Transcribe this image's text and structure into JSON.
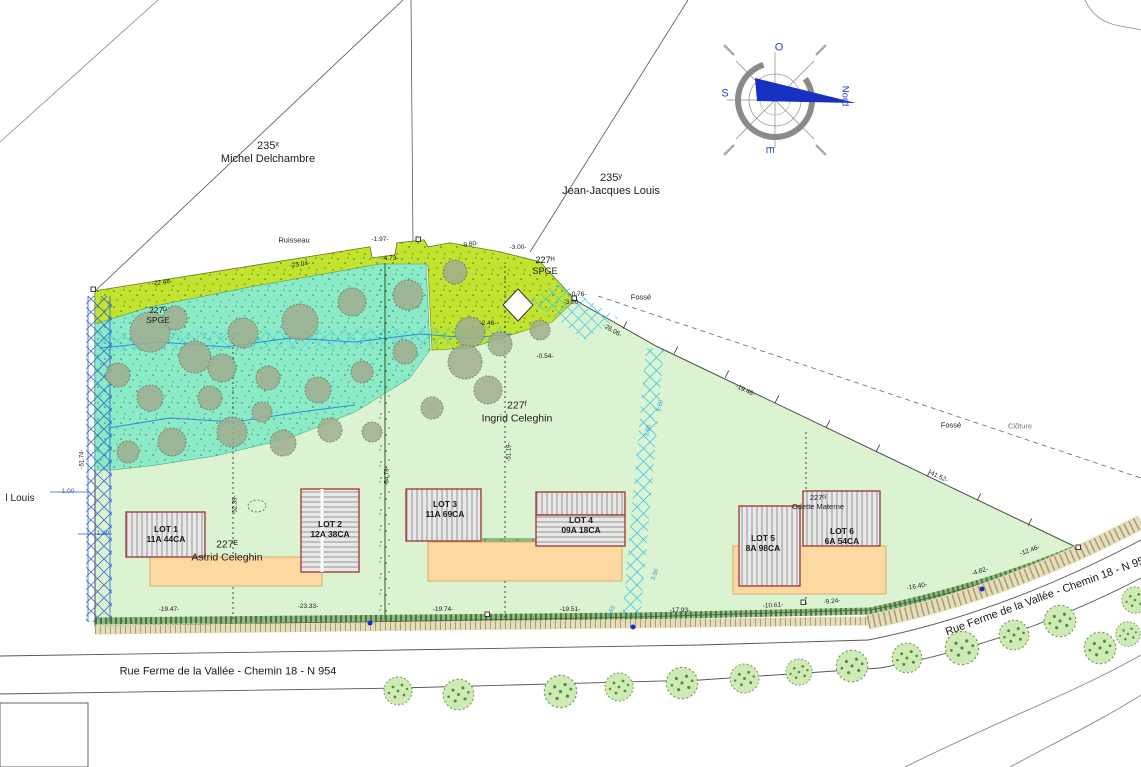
{
  "canvas": {
    "width": 1141,
    "height": 767
  },
  "colors": {
    "parcel_green": "#dcf3d2",
    "wooded_teal": "#8beac8",
    "meadow_chartreuse": "#c3e42e",
    "terrace_orange": "#fcd9a0",
    "building_hatch": "#e8e8e8",
    "building_border": "#a04040",
    "drainage_blue": "#2a5fd0",
    "drainage_cyan": "#38c4ea",
    "compass_arrow_blue": "#1630c2",
    "hedge_green": "#4e8f3f",
    "gravel_tan": "#e6ddbb"
  },
  "lots": [
    {
      "name": "LOT 1",
      "area": "11A 44CA"
    },
    {
      "name": "LOT 2",
      "area": "12A 38CA"
    },
    {
      "name": "LOT 3",
      "area": "11A 69CA"
    },
    {
      "name": "LOT 4",
      "area": "09A 18CA"
    },
    {
      "name": "LOT 5",
      "area": "8A 98CA"
    },
    {
      "name": "LOT 6",
      "area": "6A 54CA"
    }
  ],
  "annotations": [
    {
      "name": "owner-parcel-235x",
      "text": "235ˣ\nMichel Delchambre",
      "x": 268,
      "y": 153,
      "size": 11
    },
    {
      "name": "owner-parcel-235y",
      "text": "235ʸ\nJean-Jacques Louis",
      "x": 611,
      "y": 185,
      "size": 11
    },
    {
      "name": "ruisseau-label",
      "text": "Ruisseau",
      "x": 294,
      "y": 240,
      "size": 7.5
    },
    {
      "name": "measure-197",
      "text": "-1.97-",
      "x": 380,
      "y": 240,
      "size": 6.5
    },
    {
      "name": "measure-473",
      "text": "-4.73-",
      "x": 390,
      "y": 259,
      "size": 6.5
    },
    {
      "name": "measure-980",
      "text": "-9.80-",
      "x": 470,
      "y": 245,
      "size": 6.5,
      "rot": -10
    },
    {
      "name": "measure-300a",
      "text": "-3.00-",
      "x": 518,
      "y": 248,
      "size": 6.5
    },
    {
      "name": "parcel-227h-spge",
      "text": "227ᴴ\nSPGE",
      "x": 545,
      "y": 266,
      "size": 9
    },
    {
      "name": "measure-076",
      "text": "-0.76-",
      "x": 578,
      "y": 295,
      "size": 6.5
    },
    {
      "name": "measure-300b",
      "text": "-3.00-",
      "x": 572,
      "y": 303,
      "size": 6.5
    },
    {
      "name": "fosse-label-1",
      "text": "Fossé",
      "x": 641,
      "y": 297,
      "size": 7.5
    },
    {
      "name": "measure-2304",
      "text": "-23.04-",
      "x": 300,
      "y": 265,
      "size": 6.5,
      "rot": -8
    },
    {
      "name": "measure-2248",
      "text": "-22.48-",
      "x": 162,
      "y": 283,
      "size": 6.5,
      "rot": -8
    },
    {
      "name": "parcel-227d-spge",
      "text": "227ᴰ\nSPGE",
      "x": 158,
      "y": 315,
      "size": 8.5
    },
    {
      "name": "measure-2606",
      "text": "-26.06-",
      "x": 612,
      "y": 331,
      "size": 6.5,
      "rot": 30
    },
    {
      "name": "measure-1946",
      "text": "-19.46-",
      "x": 745,
      "y": 391,
      "size": 6.5,
      "rot": 25
    },
    {
      "name": "fosse-label-2",
      "text": "Fossé",
      "x": 951,
      "y": 425,
      "size": 7.5
    },
    {
      "name": "cloture-label",
      "text": "Clôture",
      "x": 1020,
      "y": 426,
      "size": 7.5,
      "color": "#777777"
    },
    {
      "name": "measure-4152",
      "text": "-41.52-",
      "x": 938,
      "y": 477,
      "size": 6.5,
      "rot": 25
    },
    {
      "name": "owner-parcel-227f",
      "text": "227ᶠ\nIngrid Celeghin",
      "x": 517,
      "y": 412,
      "size": 10.5
    },
    {
      "name": "owner-parcel-227e",
      "text": "227ᴱ\nAstrid Celeghin",
      "x": 227,
      "y": 551,
      "size": 10.5
    },
    {
      "name": "owner-parcel-227g",
      "text": "227ᴳ\nOdette Materne",
      "x": 818,
      "y": 502,
      "size": 7.5
    },
    {
      "name": "lot-1-label",
      "text": "LOT 1\n11A 44CA",
      "x": 166,
      "y": 534,
      "size": 8.5,
      "weight": "bold"
    },
    {
      "name": "lot-2-label",
      "text": "LOT 2\n12A 38CA",
      "x": 330,
      "y": 529,
      "size": 8.5,
      "weight": "bold"
    },
    {
      "name": "lot-3-label",
      "text": "LOT 3\n11A 69CA",
      "x": 445,
      "y": 509,
      "size": 8.5,
      "weight": "bold"
    },
    {
      "name": "lot-4-label",
      "text": "LOT 4\n09A 18CA",
      "x": 581,
      "y": 525,
      "size": 8.5,
      "weight": "bold"
    },
    {
      "name": "lot-5-label",
      "text": "LOT 5\n8A 98CA",
      "x": 763,
      "y": 543,
      "size": 8.5,
      "weight": "bold"
    },
    {
      "name": "lot-6-label",
      "text": "LOT 6\n6A 54CA",
      "x": 842,
      "y": 536,
      "size": 8.5,
      "weight": "bold"
    },
    {
      "name": "measure-1947",
      "text": "-19.47-",
      "x": 169,
      "y": 610,
      "size": 6.5
    },
    {
      "name": "measure-2333",
      "text": "-23.33-",
      "x": 308,
      "y": 607,
      "size": 6.5
    },
    {
      "name": "measure-1974",
      "text": "-19.74-",
      "x": 443,
      "y": 610,
      "size": 6.5
    },
    {
      "name": "measure-1951",
      "text": "-19.51-",
      "x": 570,
      "y": 610,
      "size": 6.5
    },
    {
      "name": "measure-1793",
      "text": "-17.93-",
      "x": 680,
      "y": 611,
      "size": 6.5
    },
    {
      "name": "measure-1061",
      "text": "-10.61-",
      "x": 773,
      "y": 606,
      "size": 6.5,
      "rot": -4
    },
    {
      "name": "measure-924",
      "text": "-9.24-",
      "x": 832,
      "y": 602,
      "size": 6.5,
      "rot": -5
    },
    {
      "name": "measure-1640",
      "text": "-16.40-",
      "x": 917,
      "y": 587,
      "size": 6.5,
      "rot": -10
    },
    {
      "name": "measure-482",
      "text": "-4.82-",
      "x": 980,
      "y": 572,
      "size": 6.5,
      "rot": -16
    },
    {
      "name": "measure-1246",
      "text": "-12.46-",
      "x": 1030,
      "y": 551,
      "size": 6.5,
      "rot": -20
    },
    {
      "name": "road-name-bottom",
      "text": "Rue Ferme de la Vallée - Chemin 18 - N 954",
      "x": 228,
      "y": 672,
      "size": 11
    },
    {
      "name": "road-name-right",
      "text": "Rue Ferme de la Vallée - Chemin 18 - N 954",
      "x": 1048,
      "y": 596,
      "size": 11,
      "rot": -20
    },
    {
      "name": "owner-left-cut",
      "text": "l Louis",
      "x": 20,
      "y": 499,
      "size": 10
    },
    {
      "name": "measure-5174",
      "text": "-51.74-",
      "x": 83,
      "y": 459,
      "size": 6,
      "rot": -90
    },
    {
      "name": "measure-100a",
      "text": "1.00",
      "x": 68,
      "y": 492,
      "size": 6.5,
      "color": "#2a5fd0"
    },
    {
      "name": "measure-100b",
      "text": "1.00",
      "x": 103,
      "y": 534,
      "size": 6.5,
      "color": "#2a5fd0"
    },
    {
      "name": "measure-5239",
      "text": "-52.39-",
      "x": 236,
      "y": 505,
      "size": 6,
      "rot": -90
    },
    {
      "name": "measure-5479",
      "text": "-54.79-",
      "x": 388,
      "y": 476,
      "size": 6,
      "rot": -90
    },
    {
      "name": "measure-5119",
      "text": "-51.19-",
      "x": 510,
      "y": 452,
      "size": 6,
      "rot": -90
    },
    {
      "name": "measure-160",
      "text": "1.60",
      "x": 661,
      "y": 406,
      "size": 6,
      "rot": -75,
      "color": "#2a9fd0"
    },
    {
      "name": "measure-150",
      "text": "1.50",
      "x": 649,
      "y": 431,
      "size": 6,
      "rot": -75,
      "color": "#2a9fd0"
    },
    {
      "name": "measure-350",
      "text": "3.50",
      "x": 656,
      "y": 575,
      "size": 6,
      "rot": -70,
      "color": "#2a9fd0"
    },
    {
      "name": "measure-355",
      "text": "3.55",
      "x": 612,
      "y": 612,
      "size": 6,
      "rot": -60,
      "color": "#2a9fd0"
    },
    {
      "name": "measure-054",
      "text": "-0.54-",
      "x": 545,
      "y": 357,
      "size": 6.5
    },
    {
      "name": "measure-246",
      "text": "-2.46-",
      "x": 488,
      "y": 324,
      "size": 6.5
    },
    {
      "name": "compass-west-label",
      "text": "O",
      "x": 779,
      "y": 48,
      "size": 11,
      "color": "#2a3fd0"
    },
    {
      "name": "compass-south-label",
      "text": "S",
      "x": 725,
      "y": 94,
      "size": 11,
      "color": "#2a3fd0"
    },
    {
      "name": "compass-east-label",
      "text": "E",
      "x": 769,
      "y": 150,
      "size": 11,
      "color": "#2a3fd0",
      "rot": 90
    },
    {
      "name": "compass-north-label",
      "text": "Nord",
      "x": 845,
      "y": 96,
      "size": 9.5,
      "color": "#2a3fd0",
      "rot": 90
    }
  ]
}
